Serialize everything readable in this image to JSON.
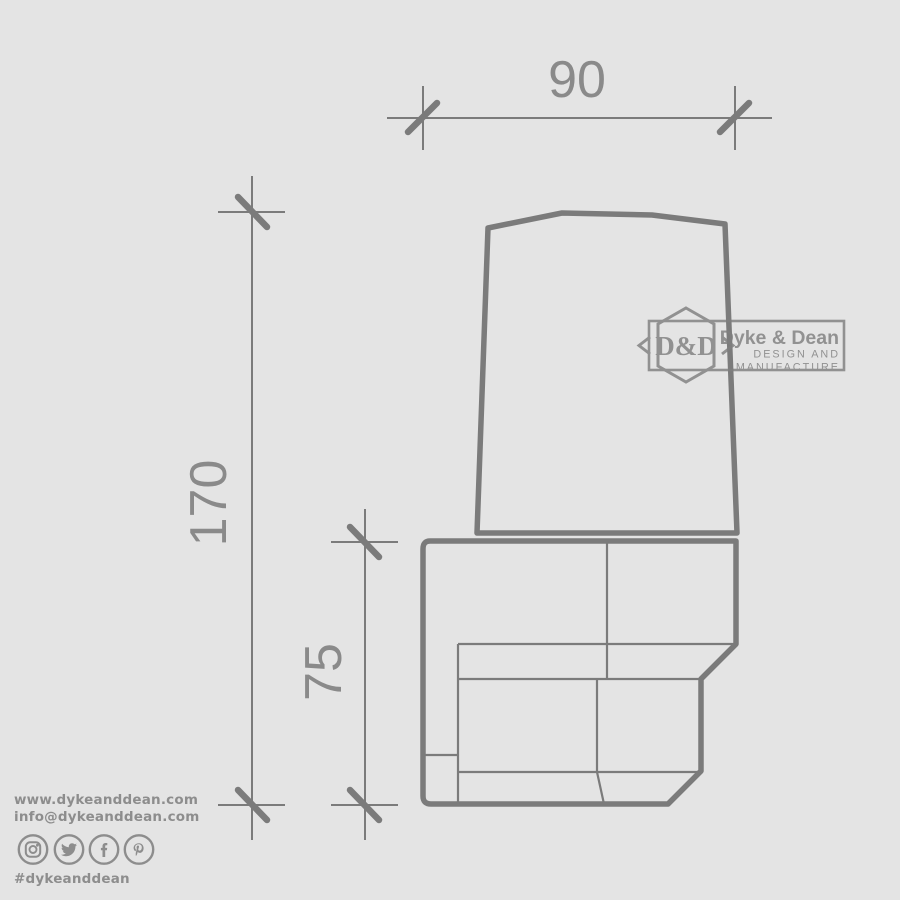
{
  "canvas": {
    "background": "#e4e4e4",
    "line_color": "#7b7b7b",
    "dimension_text_color": "#8a8a8a",
    "footer_color": "#8d8d8d",
    "logo_color": "#7f7f7f"
  },
  "drawing": {
    "dimensions": {
      "width": "90",
      "height": "170",
      "bracket_height": "75"
    }
  },
  "logo": {
    "monogram": "D&D",
    "name": "Dyke & Dean",
    "tagline_line1": "DESIGN AND",
    "tagline_line2": "MANUFACTURE"
  },
  "footer": {
    "website": "www.dykeanddean.com",
    "email": "info@dykeanddean.com",
    "hashtag": "#dykeanddean",
    "social_icons": [
      "instagram-icon",
      "twitter-icon",
      "facebook-icon",
      "pinterest-icon"
    ]
  }
}
